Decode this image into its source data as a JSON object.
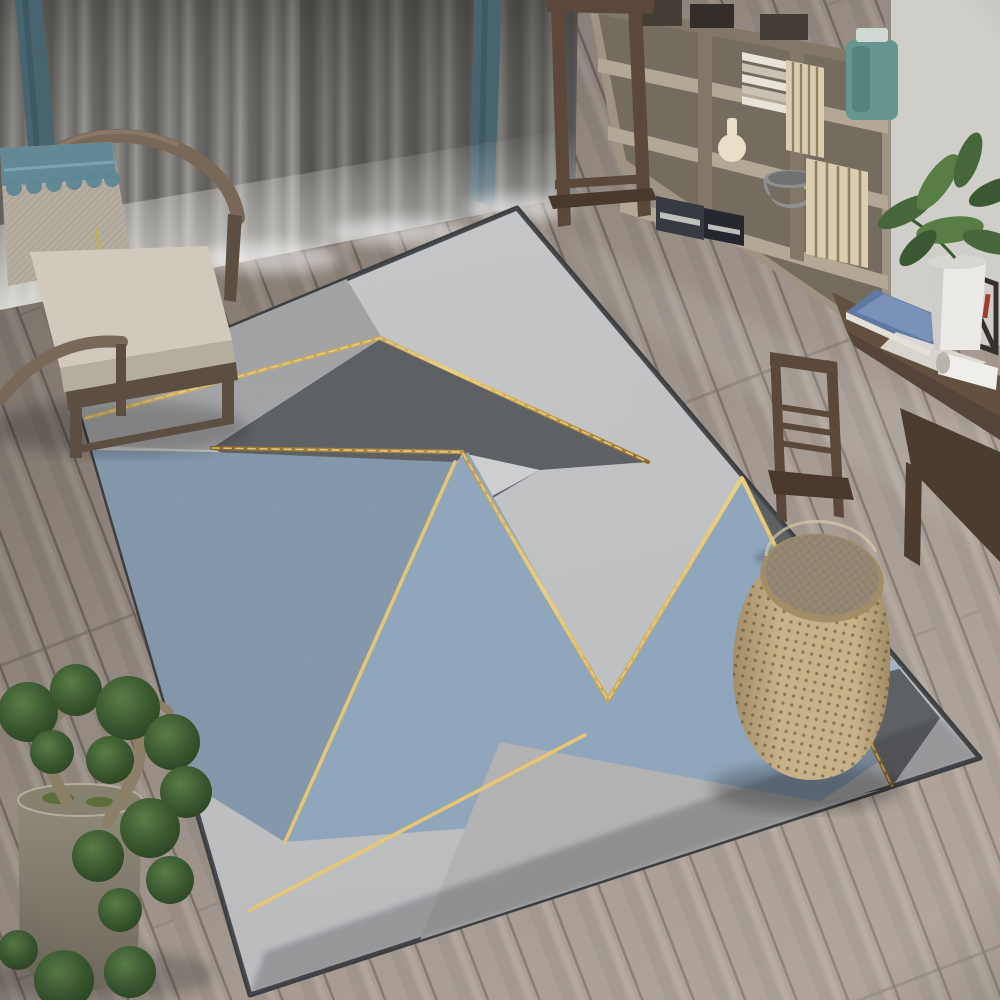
{
  "image_type": "photograph",
  "scene": "Modern living room interior viewed from above: geometric area rug in grays and blues with gold accent lines on a gray-brown wood plank floor, Chinese horseshoe armchair with cushion and tasseled pillow by gray curtains with teal accent panels, wooden display shelving with vases and books, dark wood writing desk with slat-back chair and potted plant, perforated rattan drum stool on the rug, bonsai in a stone pot at lower left",
  "objects": [
    {
      "id": "floor",
      "label": "gray-brown wood plank floor"
    },
    {
      "id": "curtains",
      "label": "gray curtains with teal accent panels and sheer hem"
    },
    {
      "id": "armchair",
      "label": "dark wood horseshoe armchair with beige cushion and lace pillow with tassel"
    },
    {
      "id": "shelving-unit",
      "label": "wood display shelf with boxes, books, teal jar, cream vase, gray bowl, slat panels, binders"
    },
    {
      "id": "side-table",
      "label": "tall dark wood plant stand"
    },
    {
      "id": "desk",
      "label": "dark walnut writing desk with blue book, papers, scroll and metal rack"
    },
    {
      "id": "desk-plant",
      "label": "green plant in white pot"
    },
    {
      "id": "desk-chair",
      "label": "wood slat-back desk chair"
    },
    {
      "id": "rug",
      "label": "geometric rug: light gray base, charcoal and slate/light blue triangles, gold zigzag lines, medium gray corners"
    },
    {
      "id": "stool",
      "label": "perforated rattan drum stool with woven fabric top"
    },
    {
      "id": "bonsai",
      "label": "bonsai tree with twisted trunk in stone pot"
    }
  ],
  "palette": {
    "floorA": "#9d9289",
    "floorB": "#948a81",
    "floorGap": "#746b62",
    "floorStreak": "#b2a89f",
    "curtainFoldDark": "#5e5d5a",
    "curtainFoldMidA": "#8f8e8a",
    "curtainFoldMidB": "#6b6a66",
    "curtainFoldLight": "#999894",
    "curtainTopShadow": "#232220",
    "sheer": "#e9e8e5",
    "teal": "#48656f",
    "tealDark": "#3a545e",
    "wall": "#cfcec9",
    "wallEdge": "#6b6257",
    "shelfWood": "#9f9384",
    "shelfWoodLight": "#b3a795",
    "shelfWoodDark": "#837768",
    "shelfCell": "#756c60",
    "slat": "#dbceb0",
    "slatLine": "#8f8165",
    "jarTeal": "#679691",
    "jarTealDark": "#49756f",
    "jarLid": "#cfd8d2",
    "vaseCream": "#e8dfc6",
    "bowlGray": "#8f9190",
    "boxDark": "#453e37",
    "boxDark2": "#332e29",
    "binder": "#363a41",
    "binderDark": "#24272d",
    "bookWhite": "#e7e3d9",
    "bookWhite2": "#c9c2b4",
    "deskWood": "#64503f",
    "deskWoodDark": "#4c3c30",
    "deskFace": "#56443a",
    "bookBlue": "#5d79a4",
    "bookBlueLight": "#8298bb",
    "paper": "#e3e0d7",
    "scroll": "#efeeea",
    "scrollEnd": "#b9b5ac",
    "rack": "#34312d",
    "redPen": "#a33b2e",
    "potWhite": "#eceae5",
    "potWhiteShade": "#cfcdc8",
    "leafA": "#46663b",
    "leafB": "#587e45",
    "leafC": "#3a5832",
    "armWood": "#796857",
    "armWoodHi": "#8d7c6b",
    "armWoodDark": "#5d4e42",
    "cushion": "#d1cabc",
    "cushionSide": "#b5ad9e",
    "pillow": "#b6ada1",
    "pillowWeave": "#a49b8e",
    "lace": "#5e8795",
    "laceLight": "#7ba3b0",
    "tassel": "#c3ac51",
    "deskChairWood": "#5c483a",
    "deskChairWoodDark": "#4a382c",
    "stoolBody": "#c7b189",
    "stoolBodyDark": "#a28d66",
    "stoolDot": "#594a33",
    "stoolTop": "#978874",
    "stoolTopDark": "#7d7060",
    "stoolRim": "#d9c9a8",
    "potStone": "#928c7c",
    "potStoneDark": "#6e695c",
    "potRim": "#b5ae9c",
    "trunk": "#8c7f68",
    "moss": "#5c6e3c",
    "foliage": "#3a5830",
    "foliageDark": "#273f1d",
    "rugBase": "#c7c8ca",
    "rugBase2": "#babbbd",
    "rugMedGray": "#9fa0a2",
    "rugCharcoal": "#54575b",
    "rugSlate": "#7e93a9",
    "rugBlue": "#8ba3bb",
    "rugInsetBlue": "#9fb2c6",
    "rugNotch": "#ced0d2",
    "rugBottomGray": "#b2b1b1",
    "rugEdge": "#3c3f42",
    "gold": "#c59a36",
    "goldDeep": "#8a6420",
    "goldBright": "#f0d27a"
  }
}
